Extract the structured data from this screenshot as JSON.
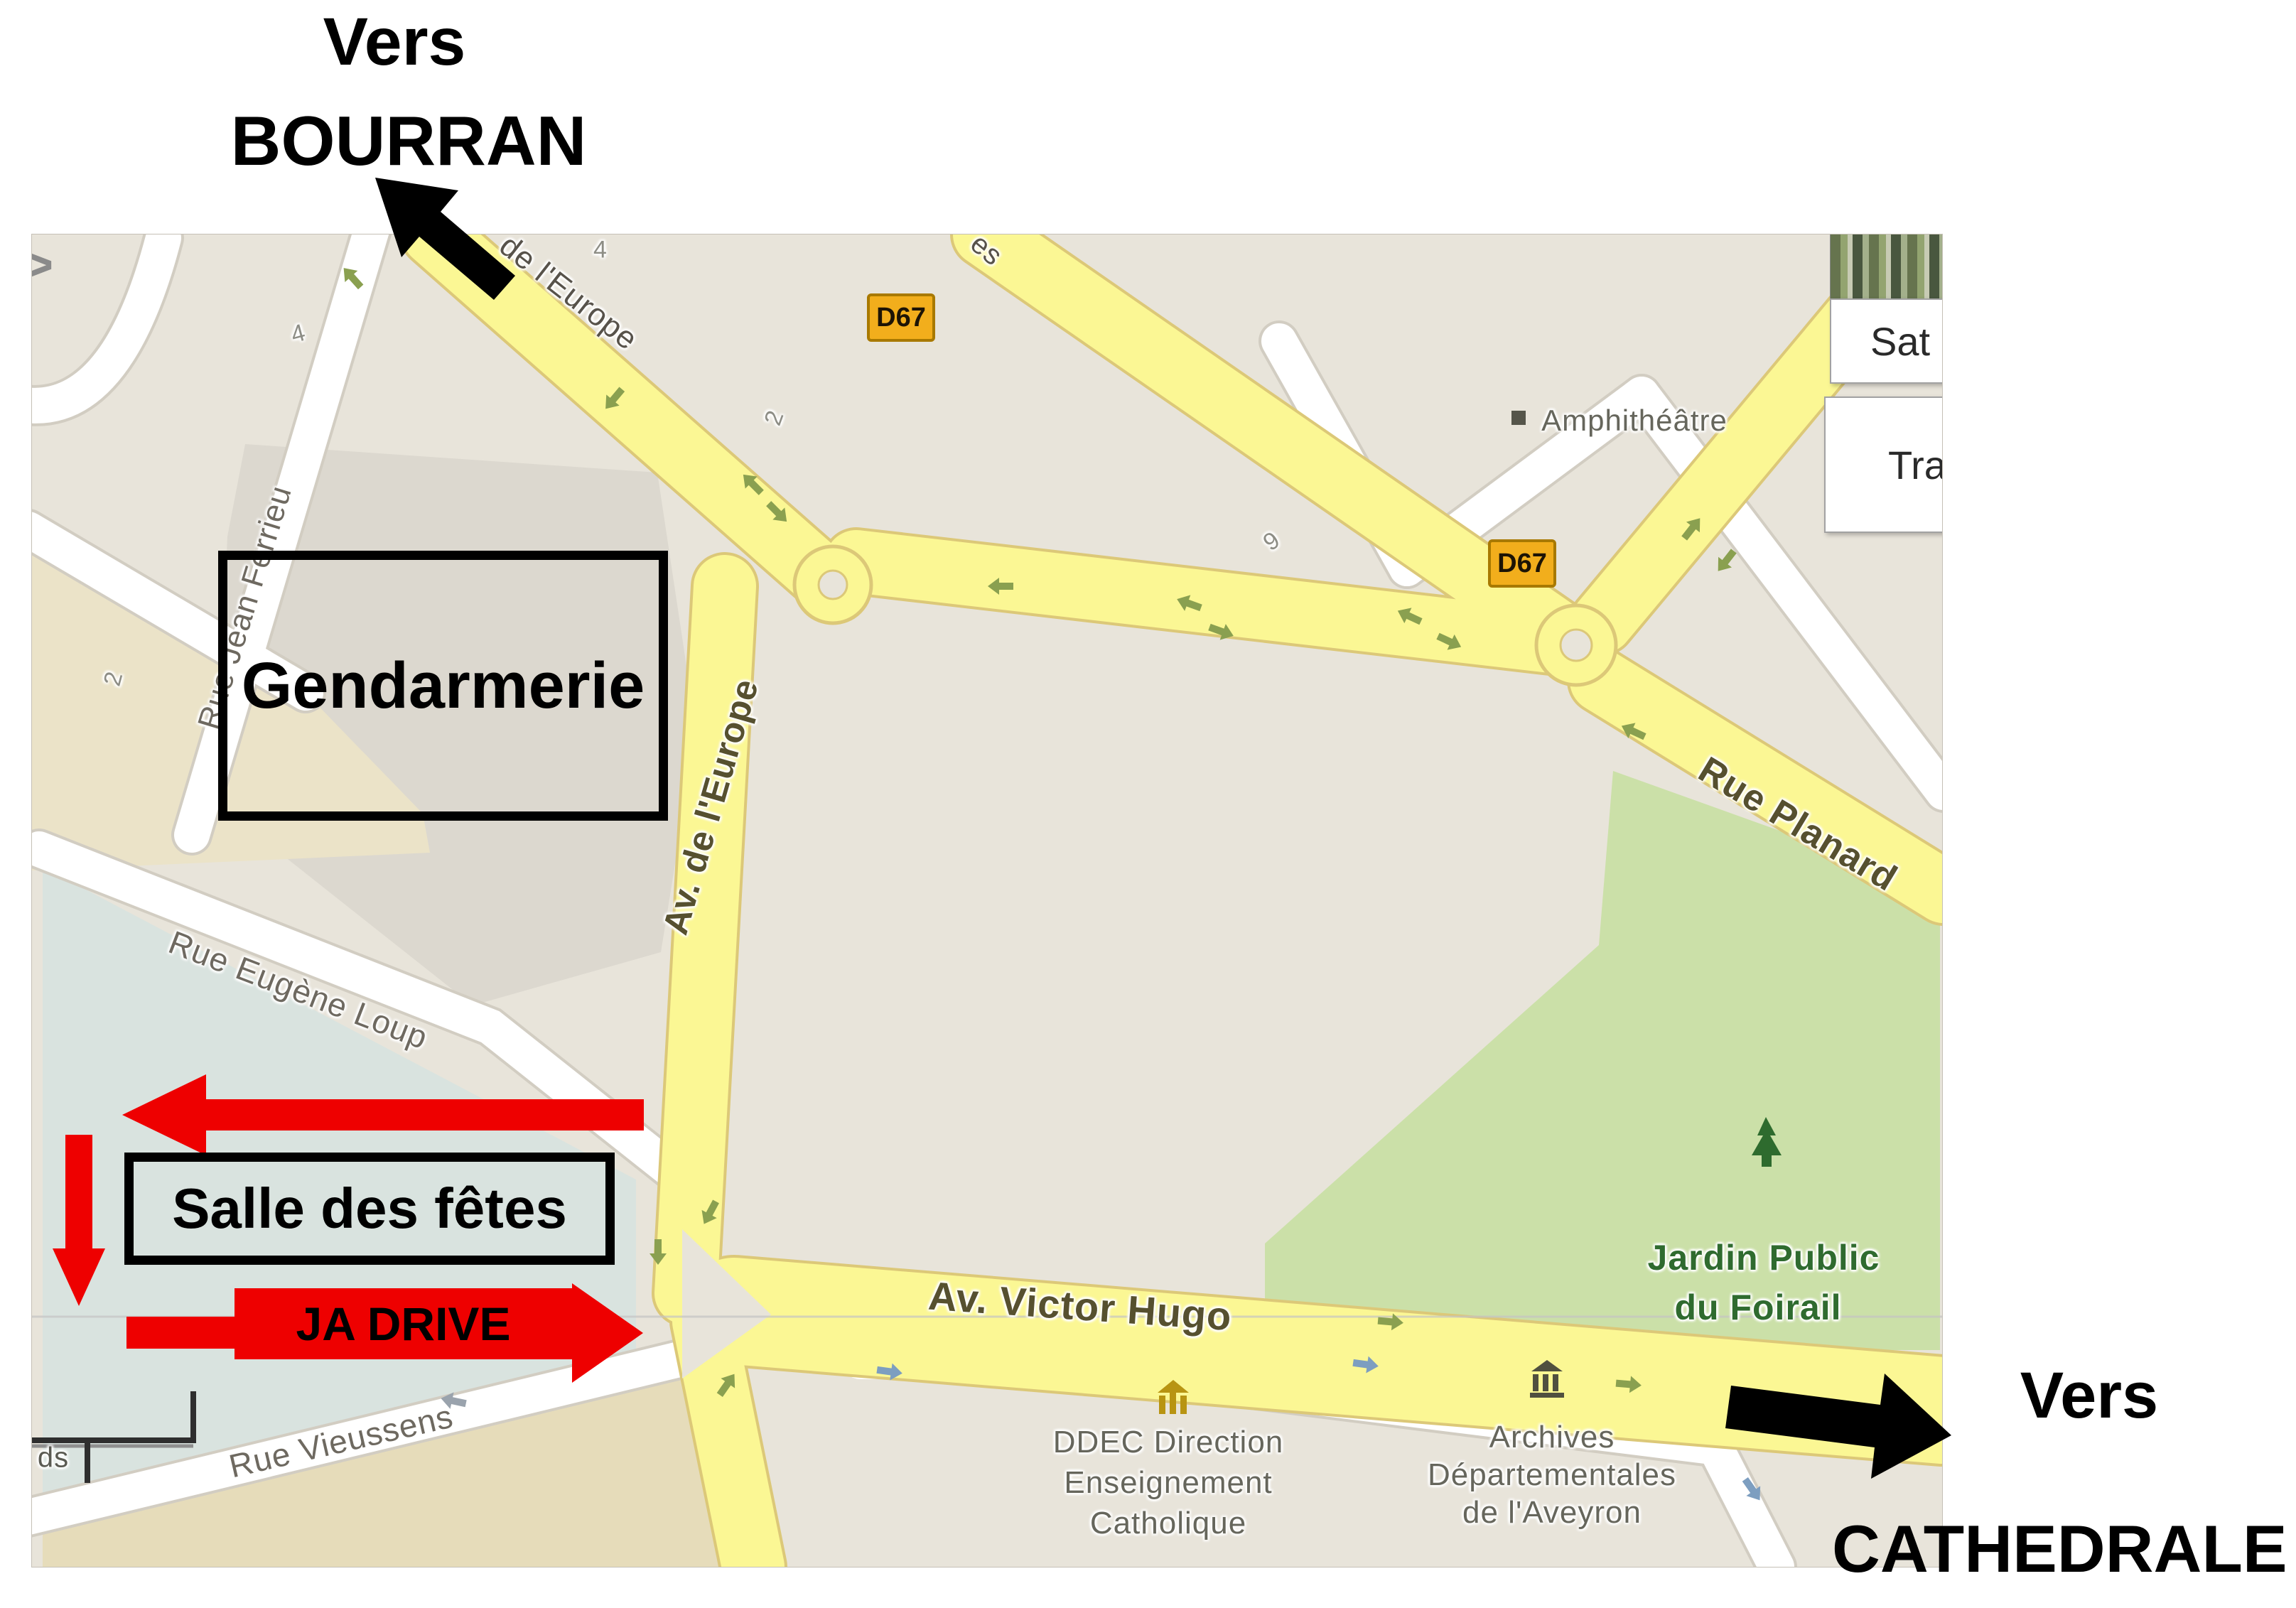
{
  "annotations": {
    "bourran": {
      "line1": "Vers",
      "line2": "BOURRAN"
    },
    "cathedrale": {
      "line1": "Vers",
      "line2": "CATHEDRALE"
    },
    "gendarmerie": {
      "label": "Gendarmerie"
    },
    "salle": {
      "label": "Salle des fêtes"
    },
    "jadrive": {
      "label": "JA DRIVE"
    },
    "colors": {
      "route_red": "#ee0000",
      "annotation_black": "#000000"
    }
  },
  "map": {
    "ui": {
      "satellite_label": "Sat",
      "traffic_label": "Tra",
      "pan_chevron": ">"
    },
    "badges": [
      {
        "label": "D67"
      },
      {
        "label": "D67"
      }
    ],
    "streets": [
      {
        "text": "de l'Europe"
      },
      {
        "text": "Av. de l'Europe"
      },
      {
        "text": "Rue Jean Ferrieu"
      },
      {
        "text": "Rue Eugène Loup"
      },
      {
        "text": "Rue Vieussens"
      },
      {
        "text": "Av. Victor Hugo"
      },
      {
        "text": "Rue Planard"
      },
      {
        "text": "es"
      }
    ],
    "pois": {
      "amphitheatre": {
        "label": "Amphithéâtre"
      },
      "jardin": {
        "line1": "Jardin Public",
        "line2": "du Foirail"
      },
      "ddec": {
        "line1": "DDEC Direction",
        "line2": "Enseignement",
        "line3": "Catholique"
      },
      "archives": {
        "line1": "Archives",
        "line2": "Départementales",
        "line3": "de l'Aveyron"
      }
    },
    "house_numbers": [
      {
        "text": "4"
      },
      {
        "text": "4"
      },
      {
        "text": "2"
      },
      {
        "text": "2"
      },
      {
        "text": "9"
      }
    ],
    "scale_fragment": "ds",
    "colors": {
      "base": "#e8e4da",
      "parcel": "#dcd8cf",
      "tan": "#ebe3c8",
      "teal": "#d9e3df",
      "tan_south": "#e6dcba",
      "park_green": "#cbe0a8",
      "road_yellow": "#fbf794",
      "road_yellow_border": "#dcc878",
      "road_white": "#ffffff",
      "road_white_border": "#d2cdc2",
      "badge_fill": "#f2ae1c"
    }
  }
}
